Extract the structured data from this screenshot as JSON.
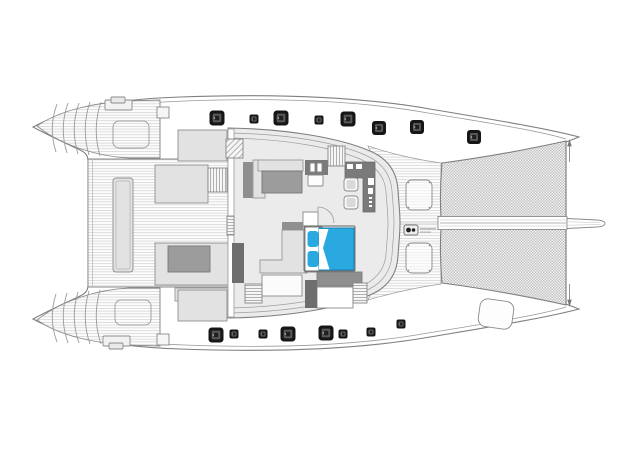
{
  "plan": {
    "vessel": "catamaran-deck-plan",
    "canvas": {
      "width": 640,
      "height": 452
    },
    "palette": {
      "outline": "#7f7f7f",
      "outline_light": "#a6a6a6",
      "plank_line": "#c5c5c5",
      "deck_white": "#ffffff",
      "floor": "#ebebeb",
      "furniture_light": "#e2e2e2",
      "furniture_mid": "#9c9c9c",
      "furniture_dark": "#7a7a7a",
      "wall_dark": "#6e6e6e",
      "hatch_black": "#161616",
      "hatch_inner": "#575757",
      "accent_cyan": "#2aa9e0",
      "net_cell": "#bdbdbd"
    },
    "deck_hatches": {
      "port_side": [
        {
          "cx": 217,
          "cy": 118,
          "size": 15
        },
        {
          "cx": 254,
          "cy": 119,
          "size": 9
        },
        {
          "cx": 281,
          "cy": 118,
          "size": 15
        },
        {
          "cx": 319,
          "cy": 120,
          "size": 9
        },
        {
          "cx": 348,
          "cy": 119,
          "size": 15
        },
        {
          "cx": 379,
          "cy": 128,
          "size": 14
        },
        {
          "cx": 417,
          "cy": 127,
          "size": 14
        },
        {
          "cx": 474,
          "cy": 137,
          "size": 14
        }
      ],
      "starboard_side": [
        {
          "cx": 216,
          "cy": 335,
          "size": 15
        },
        {
          "cx": 234,
          "cy": 334,
          "size": 9
        },
        {
          "cx": 263,
          "cy": 334,
          "size": 9
        },
        {
          "cx": 288,
          "cy": 334,
          "size": 15
        },
        {
          "cx": 326,
          "cy": 333,
          "size": 15
        },
        {
          "cx": 343,
          "cy": 334,
          "size": 9
        },
        {
          "cx": 371,
          "cy": 332,
          "size": 9
        },
        {
          "cx": 401,
          "cy": 324,
          "size": 9
        }
      ]
    },
    "foredeck_hatches": [
      {
        "x": 406,
        "y": 180,
        "w": 26,
        "h": 30
      },
      {
        "x": 406,
        "y": 243,
        "w": 26,
        "h": 30
      }
    ],
    "stern_hatches": [
      {
        "x": 113,
        "y": 121,
        "w": 36,
        "h": 27
      },
      {
        "x": 115,
        "y": 300,
        "w": 36,
        "h": 25
      }
    ],
    "blocks": [
      {
        "name": "aft-table-outer",
        "x": 113,
        "y": 178,
        "w": 20,
        "h": 94,
        "fill": "furniture_light",
        "stroke": "#8f8f8f",
        "rx": 3
      },
      {
        "name": "aft-table-inner",
        "x": 116,
        "y": 181,
        "w": 14,
        "h": 88,
        "fill": "none",
        "stroke": "#bdbdbd",
        "rx": 2
      },
      {
        "name": "cockpit-bench-forward",
        "x": 155,
        "y": 165,
        "w": 53,
        "h": 38,
        "fill": "furniture_light",
        "stroke": "#8f8f8f",
        "rx": 0
      },
      {
        "name": "cockpit-sofa-aft-group",
        "x": 155,
        "y": 243,
        "w": 73,
        "h": 42,
        "fill": "furniture_light",
        "stroke": "#8f8f8f",
        "rx": 0
      },
      {
        "name": "cockpit-table-aft",
        "x": 168,
        "y": 246,
        "w": 42,
        "h": 26,
        "fill": "furniture_mid",
        "stroke": "#7a7a7a",
        "rx": 0
      },
      {
        "name": "cockpit-bench-aft",
        "x": 175,
        "y": 288,
        "w": 53,
        "h": 13,
        "fill": "furniture_light",
        "stroke": "#9a9a9a",
        "rx": 0
      },
      {
        "name": "transom-locker-port",
        "x": 178,
        "y": 130,
        "w": 49,
        "h": 31,
        "fill": "furniture_light",
        "stroke": "#8f8f8f",
        "rx": 0
      },
      {
        "name": "transom-locker-starboard",
        "x": 178,
        "y": 290,
        "w": 49,
        "h": 31,
        "fill": "furniture_light",
        "stroke": "#8f8f8f",
        "rx": 0
      },
      {
        "name": "saloon-aft-bulkhead",
        "x": 228,
        "y": 129,
        "w": 6,
        "h": 188,
        "fill": "#ffffff",
        "stroke": "#a5a5a5",
        "rx": 0
      },
      {
        "name": "sofa-back-port",
        "x": 243,
        "y": 162,
        "w": 10,
        "h": 36,
        "fill": "#8f8f8f",
        "stroke": "none",
        "rx": 0
      },
      {
        "name": "sofa-seat-port",
        "x": 253,
        "y": 160,
        "w": 12,
        "h": 38,
        "fill": "furniture_light",
        "stroke": "#9a9a9a",
        "rx": 0
      },
      {
        "name": "sofa-chaise-port",
        "x": 258,
        "y": 160,
        "w": 45,
        "h": 11,
        "fill": "furniture_light",
        "stroke": "#9a9a9a",
        "rx": 0
      },
      {
        "name": "saloon-coffee-table",
        "x": 262,
        "y": 171,
        "w": 40,
        "h": 22,
        "fill": "furniture_mid",
        "stroke": "#777777",
        "rx": 0
      },
      {
        "name": "galley-unit",
        "x": 305,
        "y": 160,
        "w": 23,
        "h": 15,
        "fill": "furniture_dark",
        "stroke": "none",
        "rx": 0
      },
      {
        "name": "galley-sink-left",
        "x": 310,
        "y": 163,
        "w": 5,
        "h": 9,
        "fill": "#ffffff",
        "stroke": "#888888",
        "rx": 1
      },
      {
        "name": "galley-sink-right",
        "x": 317,
        "y": 163,
        "w": 5,
        "h": 9,
        "fill": "#ffffff",
        "stroke": "#888888",
        "rx": 1
      },
      {
        "name": "galley-stool",
        "x": 308,
        "y": 175,
        "w": 15,
        "h": 11,
        "fill": "#fdfdfd",
        "stroke": "#888888",
        "rx": 1
      },
      {
        "name": "cabin-door-panel",
        "x": 232,
        "y": 243,
        "w": 12,
        "h": 40,
        "fill": "wall_dark",
        "stroke": "none",
        "rx": 0
      },
      {
        "name": "bed-nightstand",
        "x": 303,
        "y": 212,
        "w": 15,
        "h": 14,
        "fill": "#ffffff",
        "stroke": "#888888",
        "rx": 0
      },
      {
        "name": "bed-headboard",
        "x": 305,
        "y": 227,
        "w": 17,
        "h": 45,
        "fill": "#ffffff",
        "stroke": "#777777",
        "rx": 0
      },
      {
        "name": "bed-mattress",
        "x": 319,
        "y": 228,
        "w": 35,
        "h": 42,
        "fill": "accent_cyan",
        "stroke": "#1080b5",
        "rx": 0
      },
      {
        "name": "bed-pillow-port",
        "x": 307.5,
        "y": 231,
        "w": 11,
        "h": 16,
        "fill": "accent_cyan",
        "stroke": "none",
        "rx": 3
      },
      {
        "name": "bed-pillow-starboard",
        "x": 307.5,
        "y": 251,
        "w": 11,
        "h": 16,
        "fill": "accent_cyan",
        "stroke": "none",
        "rx": 3
      },
      {
        "name": "bed-wall-port",
        "x": 282,
        "y": 222,
        "w": 21,
        "h": 8,
        "fill": "#8f8f8f",
        "stroke": "none",
        "rx": 0
      },
      {
        "name": "lower-dresser",
        "x": 317,
        "y": 272,
        "w": 45,
        "h": 14,
        "fill": "#8f8f8f",
        "stroke": "#7a7a7a",
        "rx": 0
      },
      {
        "name": "lower-bathroom",
        "x": 317,
        "y": 287,
        "w": 36,
        "h": 21,
        "fill": "#ffffff",
        "stroke": "#8a8a8a",
        "rx": 0
      },
      {
        "name": "lower-wall-panel",
        "x": 305,
        "y": 280,
        "w": 12,
        "h": 28,
        "fill": "wall_dark",
        "stroke": "none",
        "rx": 0
      },
      {
        "name": "lower-cabinet",
        "x": 262,
        "y": 275,
        "w": 40,
        "h": 21,
        "fill": "#fbfbfb",
        "stroke": "#8a8a8a",
        "rx": 0
      },
      {
        "name": "nav-desk-item-1",
        "x": 347,
        "y": 164,
        "w": 6,
        "h": 5,
        "fill": "#ffffff",
        "stroke": "none",
        "rx": 0.5
      },
      {
        "name": "nav-desk-item-2",
        "x": 356,
        "y": 164,
        "w": 6,
        "h": 5,
        "fill": "#ffffff",
        "stroke": "none",
        "rx": 0.5
      },
      {
        "name": "nav-desk-item-3",
        "x": 368,
        "y": 178,
        "w": 6,
        "h": 7,
        "fill": "#ffffff",
        "stroke": "none",
        "rx": 0.5
      },
      {
        "name": "nav-desk-item-4",
        "x": 368,
        "y": 188,
        "w": 5,
        "h": 6,
        "fill": "#ffffff",
        "stroke": "none",
        "rx": 0.5
      },
      {
        "name": "nav-desk-dot-1",
        "x": 369,
        "y": 197,
        "w": 3,
        "h": 2,
        "fill": "#ffffff",
        "stroke": "none",
        "rx": 0
      },
      {
        "name": "nav-desk-dot-2",
        "x": 369,
        "y": 201,
        "w": 3,
        "h": 2,
        "fill": "#ffffff",
        "stroke": "none",
        "rx": 0
      },
      {
        "name": "nav-desk-dot-3",
        "x": 369,
        "y": 205,
        "w": 3,
        "h": 2,
        "fill": "#ffffff",
        "stroke": "none",
        "rx": 0
      },
      {
        "name": "nav-seat-forward",
        "x": 344,
        "y": 178,
        "w": 14,
        "h": 13,
        "fill": "#f8f8f8",
        "stroke": "#8a8a8a",
        "rx": 3
      },
      {
        "name": "nav-seat-forward-pad",
        "x": 346.5,
        "y": 180,
        "w": 9,
        "h": 9,
        "fill": "#d9d9d9",
        "stroke": "none",
        "rx": 2
      },
      {
        "name": "nav-seat-aft",
        "x": 344,
        "y": 196,
        "w": 14,
        "h": 13,
        "fill": "#f8f8f8",
        "stroke": "#8a8a8a",
        "rx": 3
      },
      {
        "name": "nav-seat-aft-pad",
        "x": 346.5,
        "y": 198,
        "w": 9,
        "h": 9,
        "fill": "#d9d9d9",
        "stroke": "none",
        "rx": 2
      },
      {
        "name": "bed-frame",
        "x": 304,
        "y": 226,
        "w": 51,
        "h": 45,
        "fill": "none",
        "stroke": "#666666",
        "rx": 1
      },
      {
        "name": "bow-locker-starboard",
        "x": 479,
        "y": 300,
        "w": 34,
        "h": 28,
        "fill": "#fdfdfd",
        "stroke": "#8a8a8a",
        "rx": 8,
        "rotate": "8 496 314"
      },
      {
        "name": "deck-divider-port",
        "x": 157,
        "y": 107,
        "w": 12,
        "h": 11,
        "fill": "#f6f6f6",
        "stroke": "#8a8a8a",
        "rx": 0
      },
      {
        "name": "deck-divider-starboard",
        "x": 157,
        "y": 334,
        "w": 12,
        "h": 11,
        "fill": "#f6f6f6",
        "stroke": "#8a8a8a",
        "rx": 0
      },
      {
        "name": "stern-cleat-port-base",
        "x": 105,
        "y": 100,
        "w": 27,
        "h": 10,
        "fill": "#f2f2f2",
        "stroke": "#8a8a8a",
        "rx": 1
      },
      {
        "name": "stern-cleat-port-cap",
        "x": 111,
        "y": 97,
        "w": 14,
        "h": 6,
        "fill": "#e9e9e9",
        "stroke": "#8a8a8a",
        "rx": 1
      },
      {
        "name": "stern-cleat-starboard-base",
        "x": 103,
        "y": 336,
        "w": 27,
        "h": 10,
        "fill": "#f2f2f2",
        "stroke": "#8a8a8a",
        "rx": 1
      },
      {
        "name": "stern-cleat-starboard-cap",
        "x": 109,
        "y": 343,
        "w": 14,
        "h": 6,
        "fill": "#e9e9e9",
        "stroke": "#8a8a8a",
        "rx": 1
      }
    ],
    "stairs": [
      {
        "name": "spiral-stairs-port",
        "x": 226,
        "y": 139,
        "w": 17,
        "h": 19,
        "dir": "d"
      },
      {
        "name": "galley-companionway-steps",
        "x": 328,
        "y": 146,
        "w": 17,
        "h": 20,
        "dir": "v"
      },
      {
        "name": "cockpit-entry-steps",
        "x": 208,
        "y": 168,
        "w": 19,
        "h": 24,
        "dir": "v"
      },
      {
        "name": "saloon-door-threshold",
        "x": 227,
        "y": 216,
        "w": 7,
        "h": 19,
        "dir": "h"
      },
      {
        "name": "owner-cabin-steps",
        "x": 245,
        "y": 284,
        "w": 17,
        "h": 19,
        "dir": "h"
      },
      {
        "name": "starboard-companionway-steps",
        "x": 353,
        "y": 283,
        "w": 14,
        "h": 20,
        "dir": "h"
      }
    ],
    "windlass": {
      "x": 404,
      "y": 225,
      "w": 14,
      "h": 10,
      "drums": [
        {
          "cx": 408.5,
          "cy": 230,
          "r": 2.4
        },
        {
          "cx": 413.5,
          "cy": 230,
          "r": 1.8
        }
      ],
      "label_marks": [
        {
          "x": 420,
          "y": 228,
          "w": 16,
          "h": 1.6
        },
        {
          "x": 420,
          "y": 231.5,
          "w": 11,
          "h": 1.6
        }
      ]
    }
  }
}
